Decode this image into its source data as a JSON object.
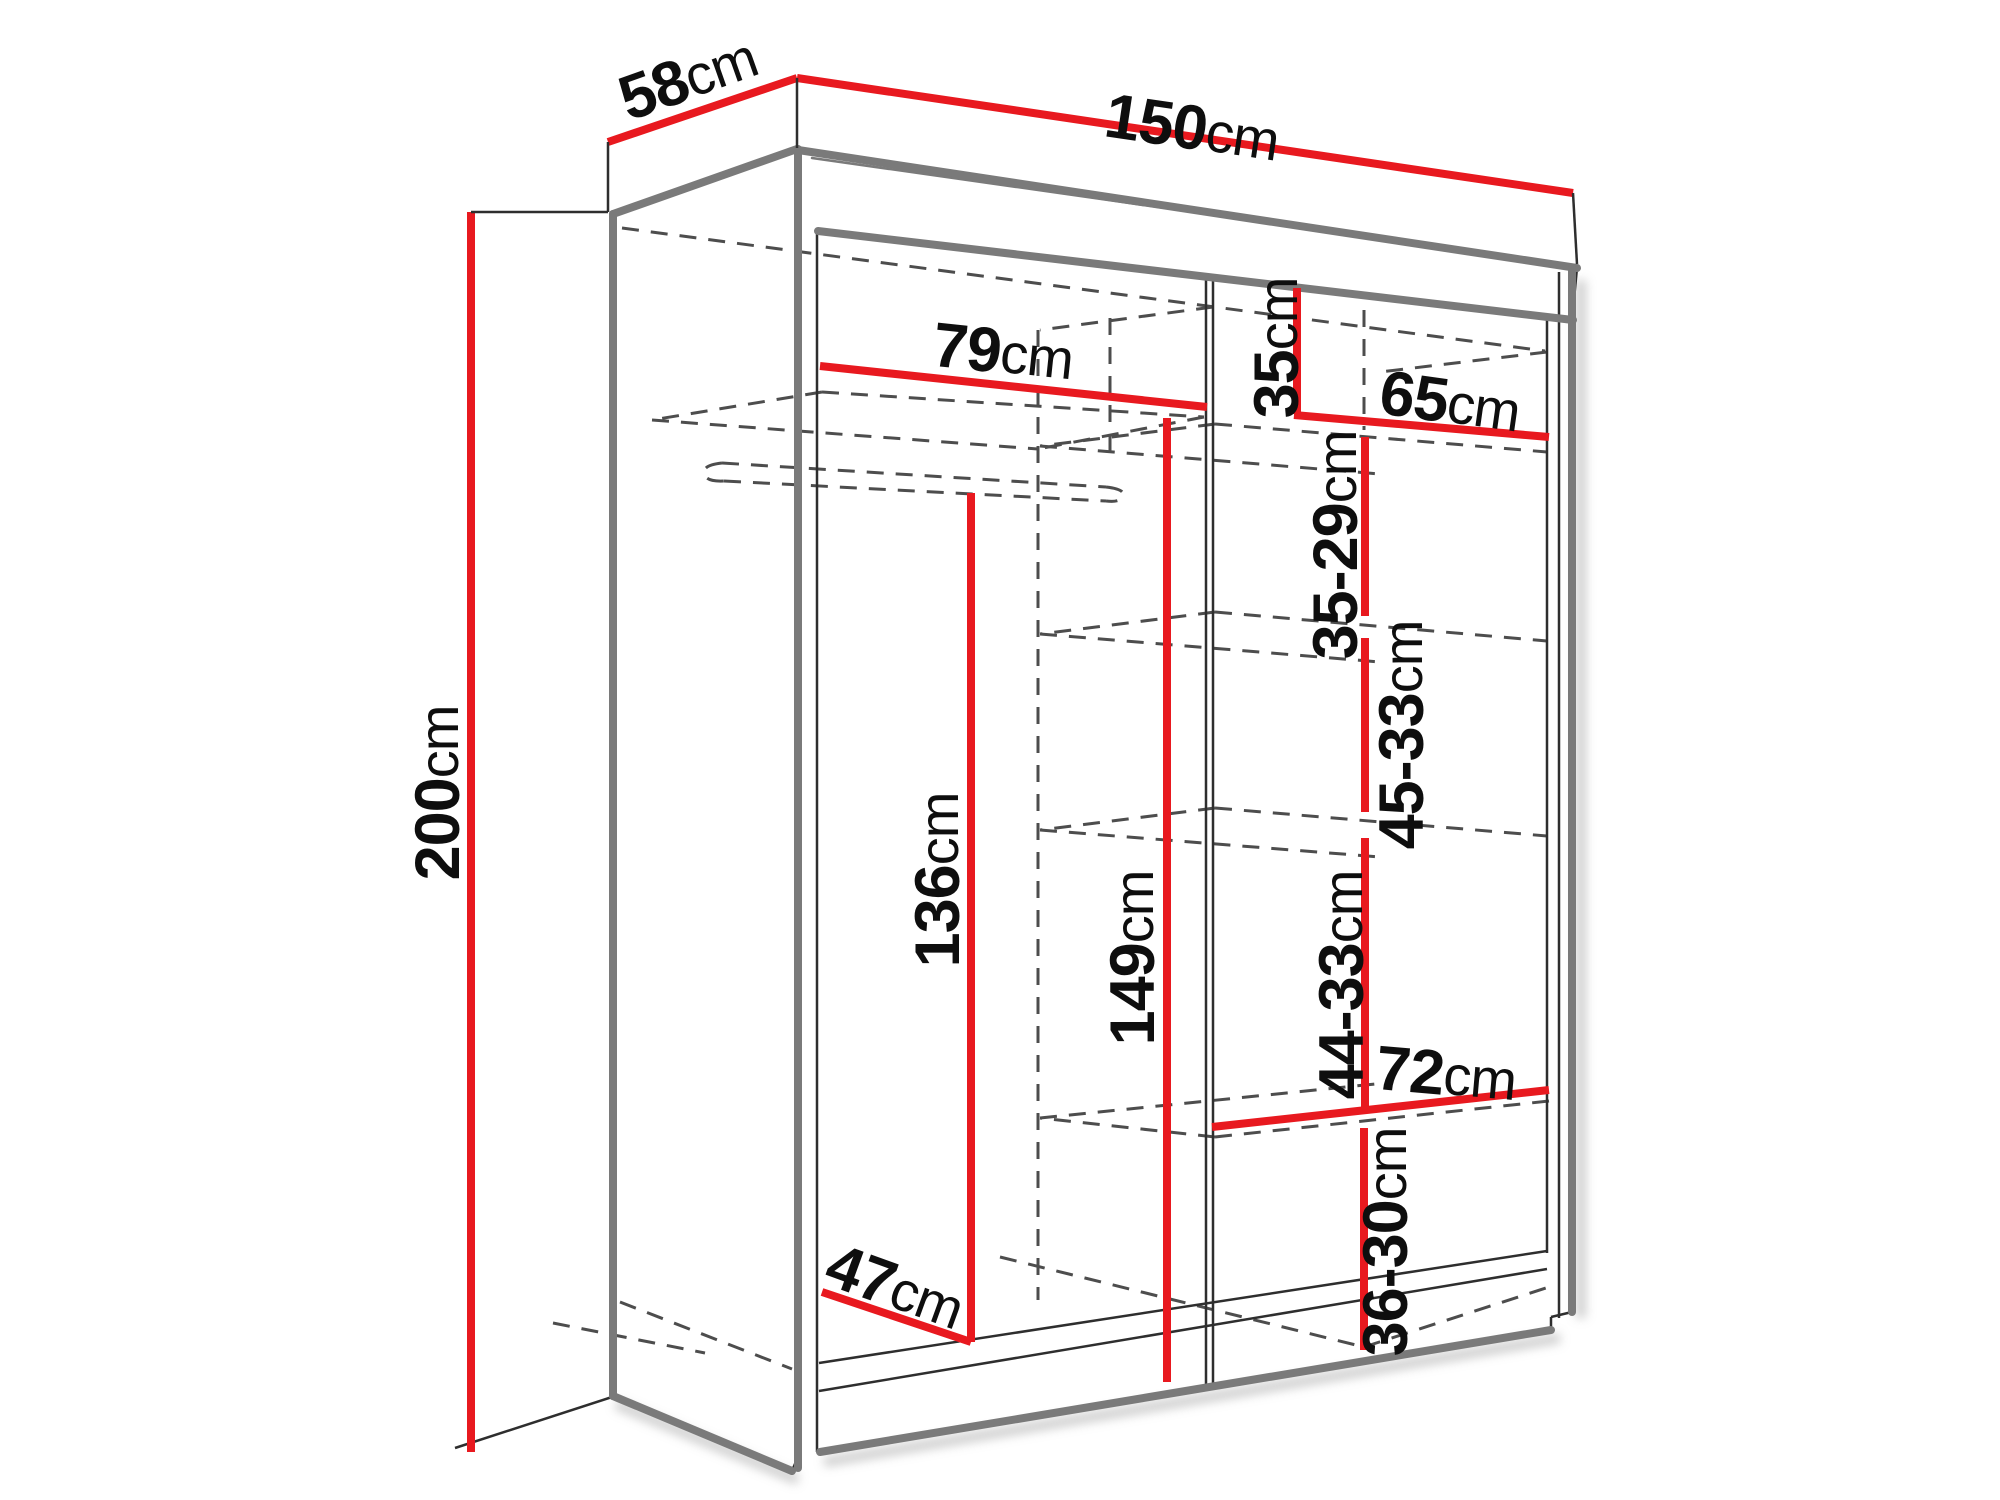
{
  "colors": {
    "dimension_red": "#e8191f",
    "outline_gray": "#7a7a7a",
    "line_dark": "#2e2e2e",
    "dashed_gray": "#4d4d4d",
    "shadow_gray": "#bdbdbd",
    "background": "#ffffff"
  },
  "dims": {
    "width_top": {
      "value": "150",
      "unit": "cm"
    },
    "depth_top": {
      "value": "58",
      "unit": "cm"
    },
    "height_left": {
      "value": "200",
      "unit": "cm"
    },
    "left_section_width": {
      "value": "79",
      "unit": "cm"
    },
    "top_shelf_height": {
      "value": "35",
      "unit": "cm"
    },
    "right_section_width": {
      "value": "65",
      "unit": "cm"
    },
    "shelf_spacing_upper": {
      "value": "35-29",
      "unit": "cm"
    },
    "shelf_spacing_mid": {
      "value": "45-33",
      "unit": "cm"
    },
    "left_clear_height": {
      "value": "136",
      "unit": "cm"
    },
    "center_clear_height": {
      "value": "149",
      "unit": "cm"
    },
    "shelf_spacing_lower": {
      "value": "44-33",
      "unit": "cm"
    },
    "bottom_shelf_width": {
      "value": "72",
      "unit": "cm"
    },
    "bottom_spacing": {
      "value": "36-30",
      "unit": "cm"
    },
    "interior_depth": {
      "value": "47",
      "unit": "cm"
    }
  }
}
